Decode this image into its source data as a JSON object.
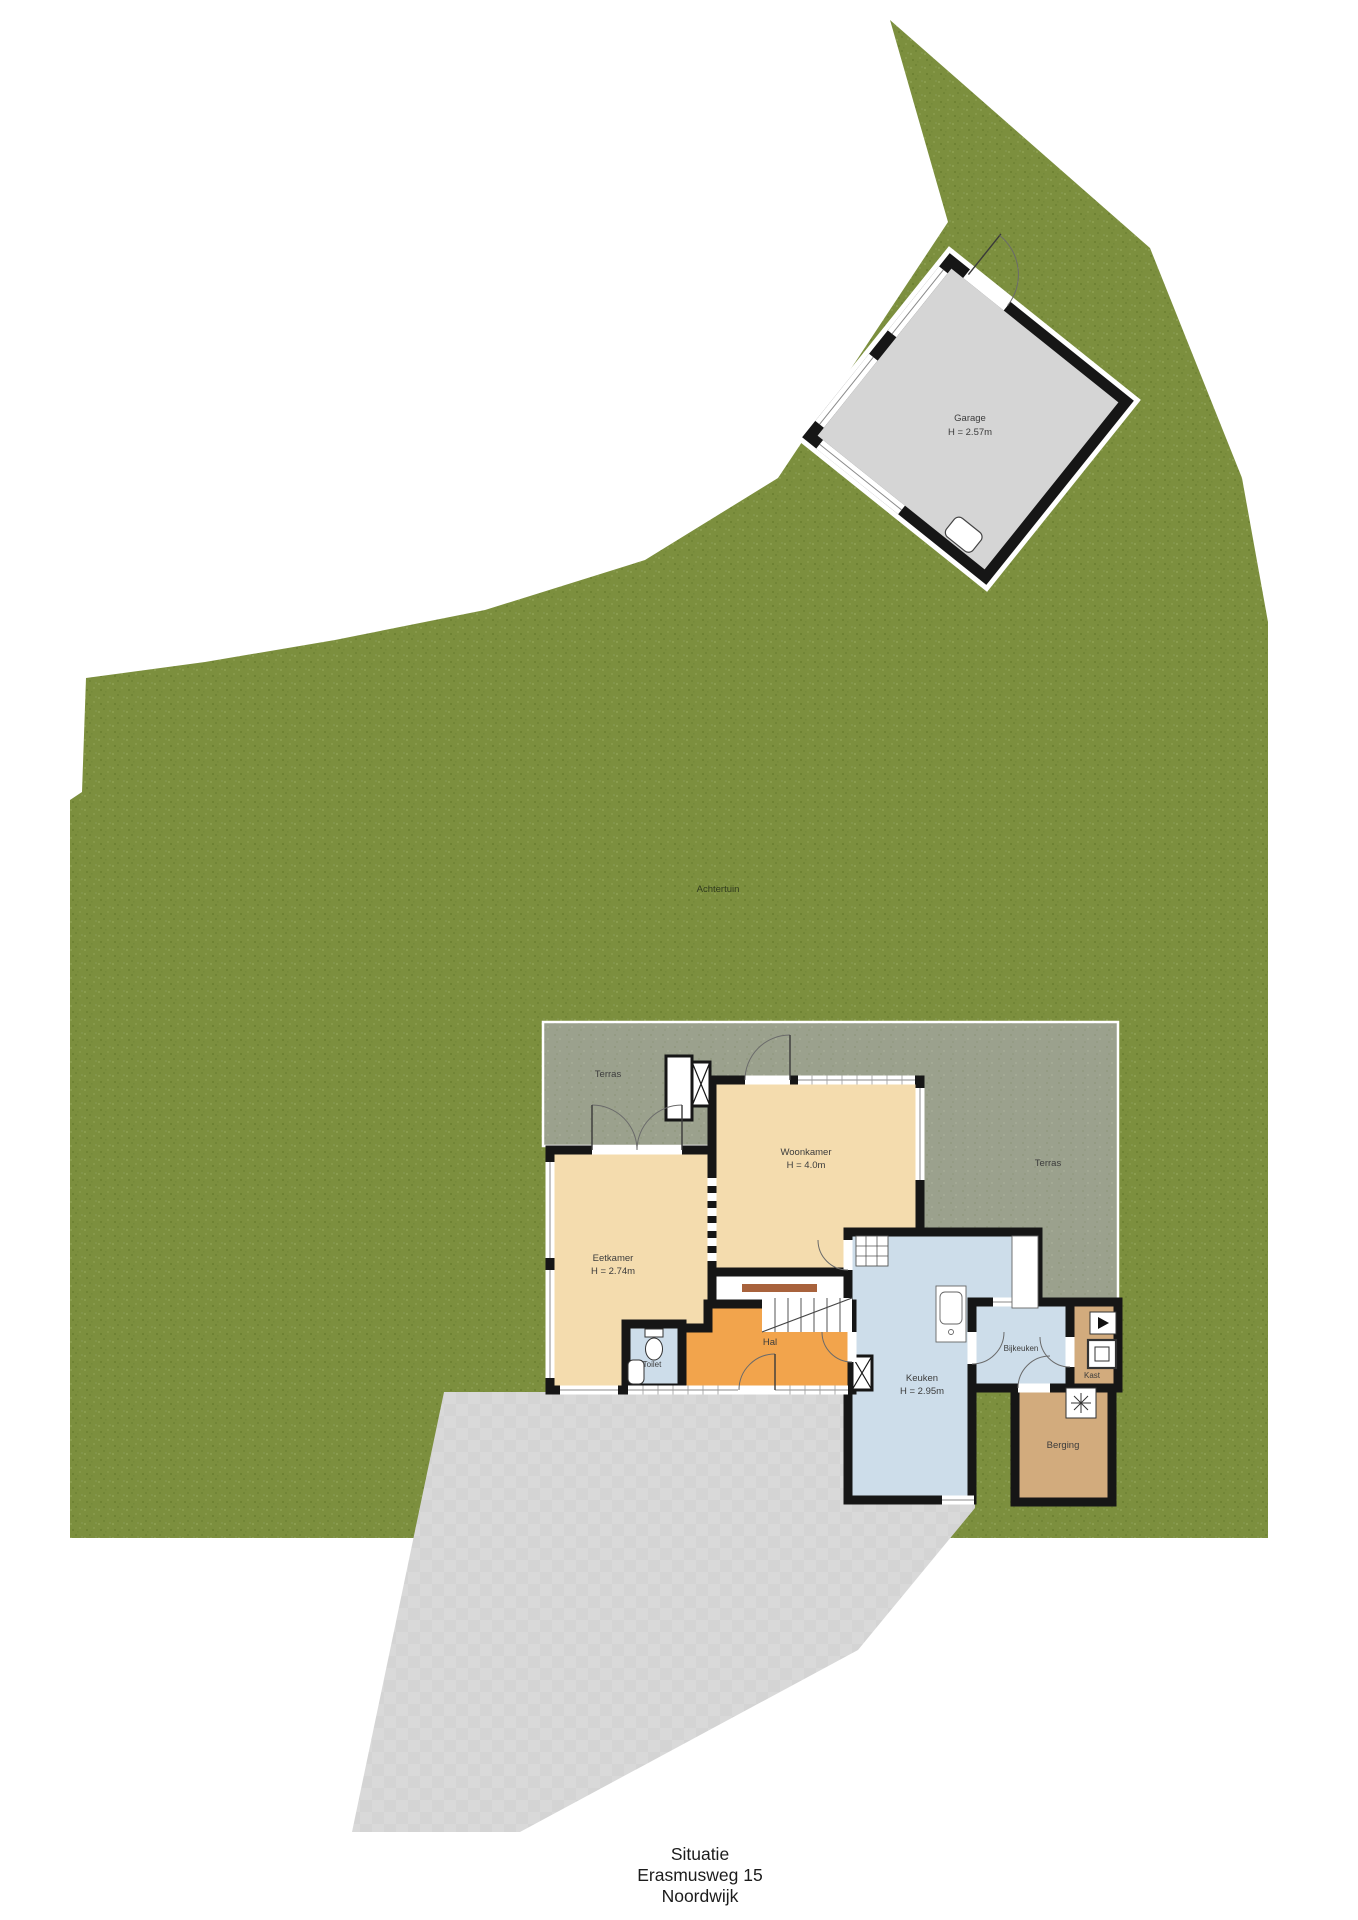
{
  "caption": {
    "lines": [
      "Situatie",
      "Erasmusweg 15",
      "Noordwijk"
    ]
  },
  "garden": {
    "backyard_label": "Achtertuin"
  },
  "garage": {
    "label": "Garage",
    "height": "H = 2.57m"
  },
  "floorplan": {
    "terras_left": {
      "label": "Terras"
    },
    "terras_right": {
      "label": "Terras"
    },
    "woonkamer": {
      "label": "Woonkamer",
      "height": "H = 4.0m"
    },
    "eetkamer": {
      "label": "Eetkamer",
      "height": "H = 2.74m"
    },
    "keuken": {
      "label": "Keuken",
      "height": "H = 2.95m"
    },
    "hal": {
      "label": "Hal"
    },
    "toilet": {
      "label": "Toilet"
    },
    "bijkeuken": {
      "label": "Bijkeuken"
    },
    "kast": {
      "label": "Kast"
    },
    "berging": {
      "label": "Berging"
    }
  },
  "colors": {
    "grass": "#7c8f3e",
    "terrace": "#9ba18d",
    "driveway": "#d9d9d9",
    "garage_floor": "#d5d5d5",
    "living_beige": "#f4dcae",
    "hall_orange": "#f2a44c",
    "wet_room_blue": "#cdddea",
    "storage_tan": "#d2ab7d",
    "wall_black": "#161616"
  }
}
